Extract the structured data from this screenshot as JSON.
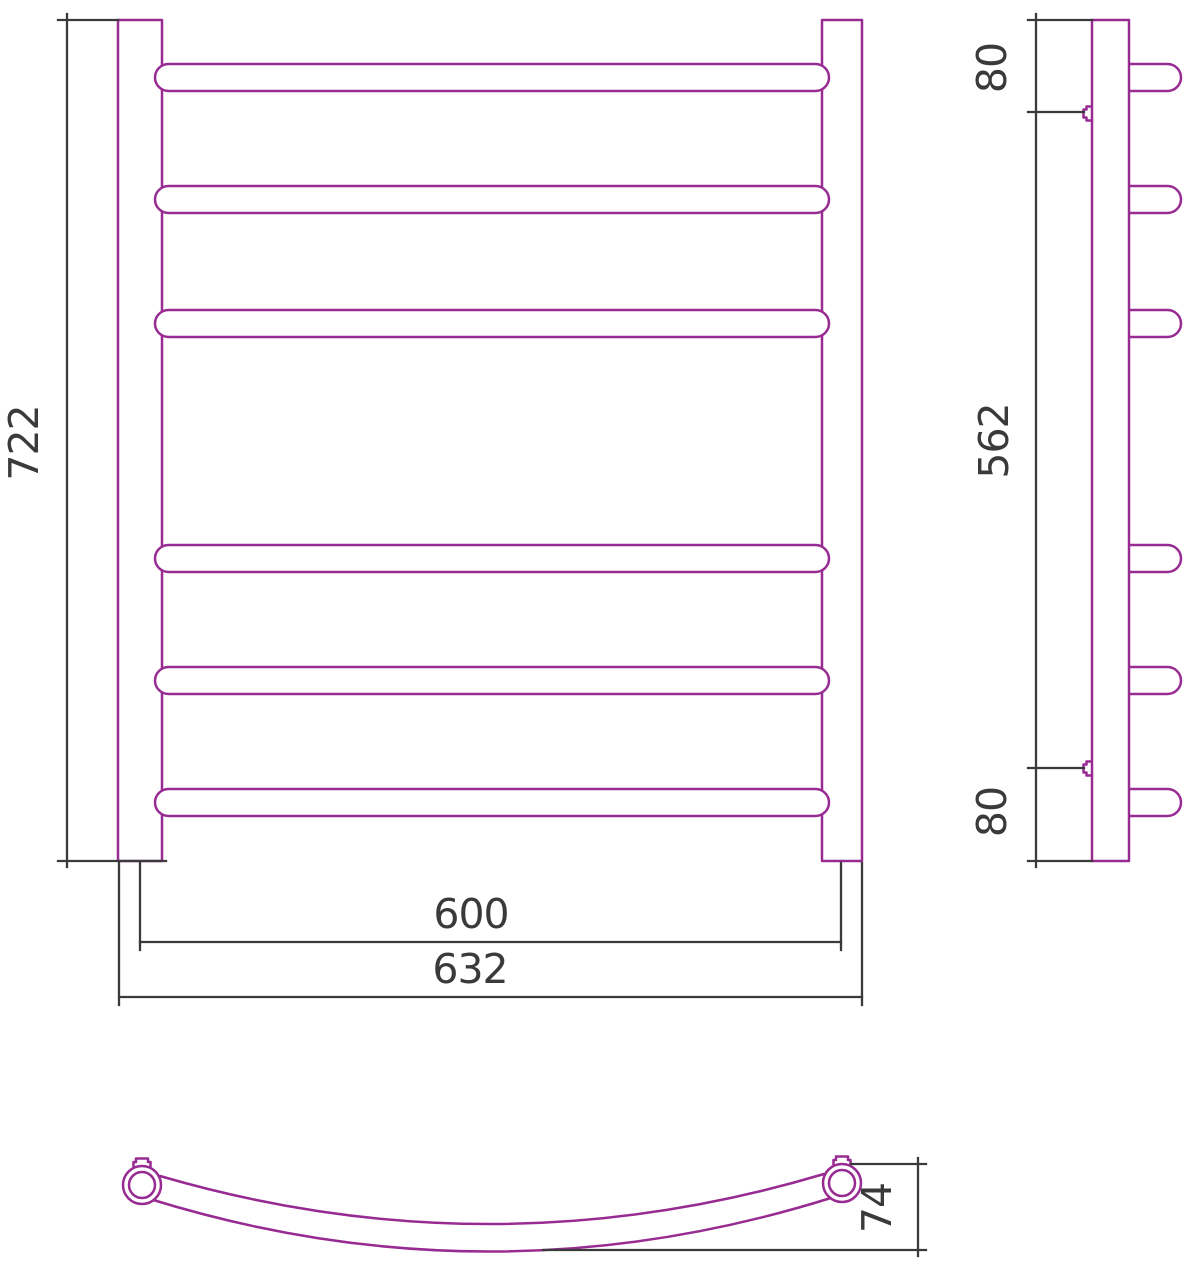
{
  "title": "Towel rail technical drawing",
  "colors": {
    "outline": "#982B92",
    "dimension": "#3A3A3A",
    "background": "#FFFFFF"
  },
  "views": {
    "front": {
      "name": "front-view",
      "bar_count": 6,
      "dimensions": {
        "overall_height": "722",
        "bar_center_span": "600",
        "overall_width": "632"
      }
    },
    "side": {
      "name": "side-view",
      "hook_count": 6,
      "bracket_count": 2,
      "dimensions": {
        "top_offset": "80",
        "bracket_span": "562",
        "bottom_offset": "80"
      }
    },
    "bottom": {
      "name": "bottom-section-view",
      "dimensions": {
        "depth": "74"
      }
    }
  }
}
